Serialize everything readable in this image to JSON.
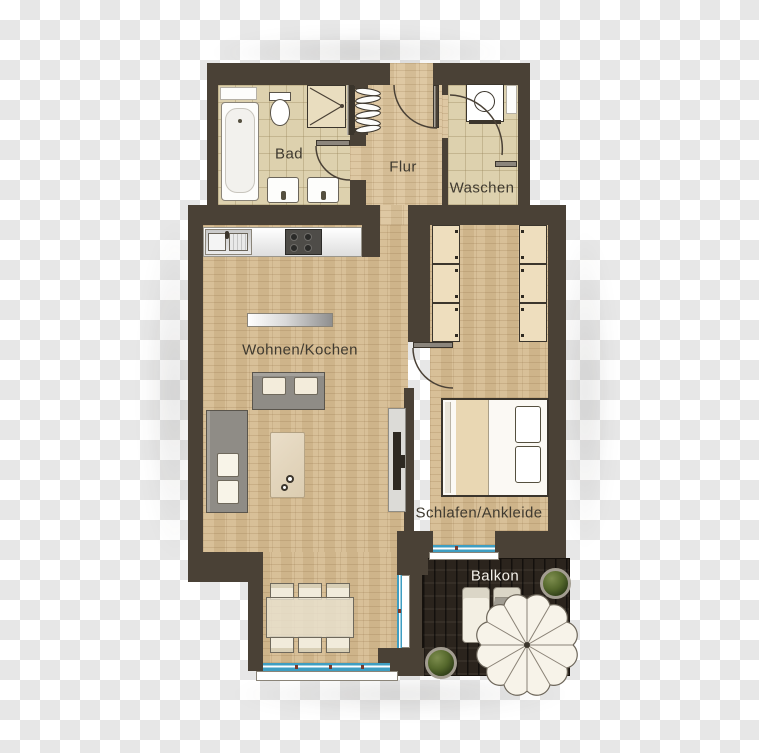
{
  "rooms": {
    "bad": {
      "label": "Bad"
    },
    "flur": {
      "label": "Flur"
    },
    "waschen": {
      "label": "Waschen"
    },
    "wohnen_kochen": {
      "label": "Wohnen/Kochen"
    },
    "schlafen_ankleide": {
      "label": "Schlafen/Ankleide"
    },
    "balkon": {
      "label": "Balkon"
    }
  },
  "colors": {
    "wall": "#4a4136",
    "floor_wood": "#d5bb91",
    "floor_tile": "#ddd1ae",
    "deck": "#2b241d",
    "window_accent": "#3e9ec2",
    "label_text": "#3f3a30",
    "balkon_text": "#f2efe8",
    "checker_light": "#ffffff",
    "checker_dark": "#e7e7e7"
  }
}
